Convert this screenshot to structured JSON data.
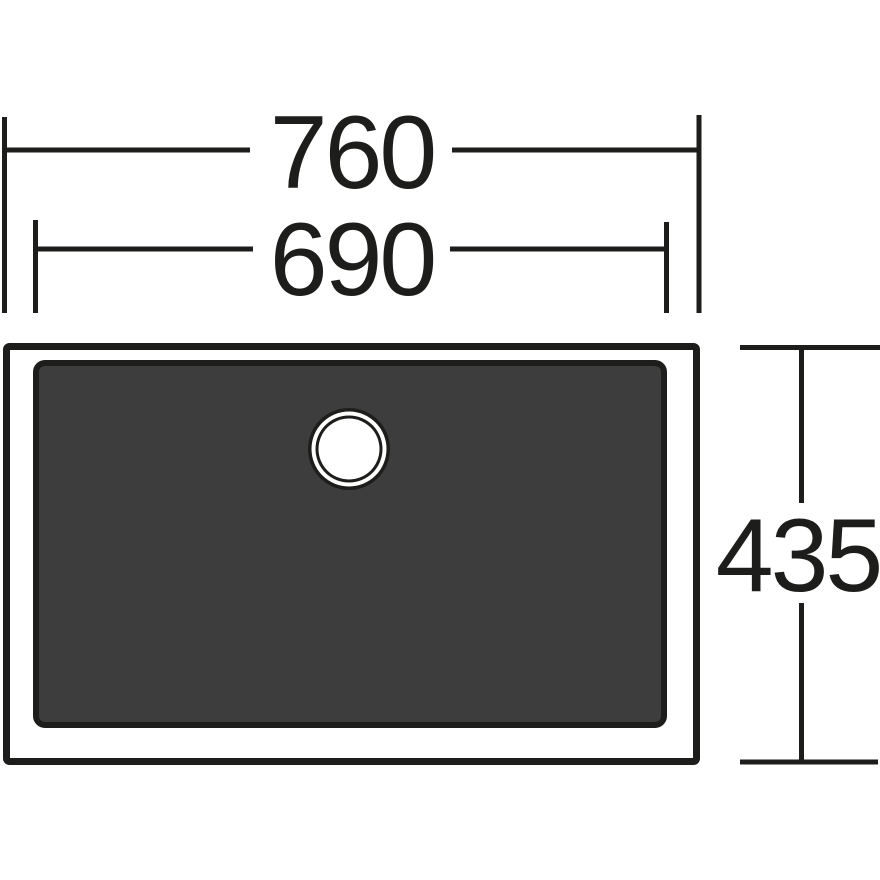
{
  "drawing": {
    "kind": "sink-top-view-dimension-drawing",
    "colors": {
      "line": "#1d1d1b",
      "basin_fill": "#3d3d3d",
      "background": "#ffffff",
      "drain_fill": "#ffffff"
    },
    "dimensions": {
      "outer_width": {
        "value": "760"
      },
      "inner_width": {
        "value": "690"
      },
      "depth": {
        "value": "435"
      }
    }
  }
}
